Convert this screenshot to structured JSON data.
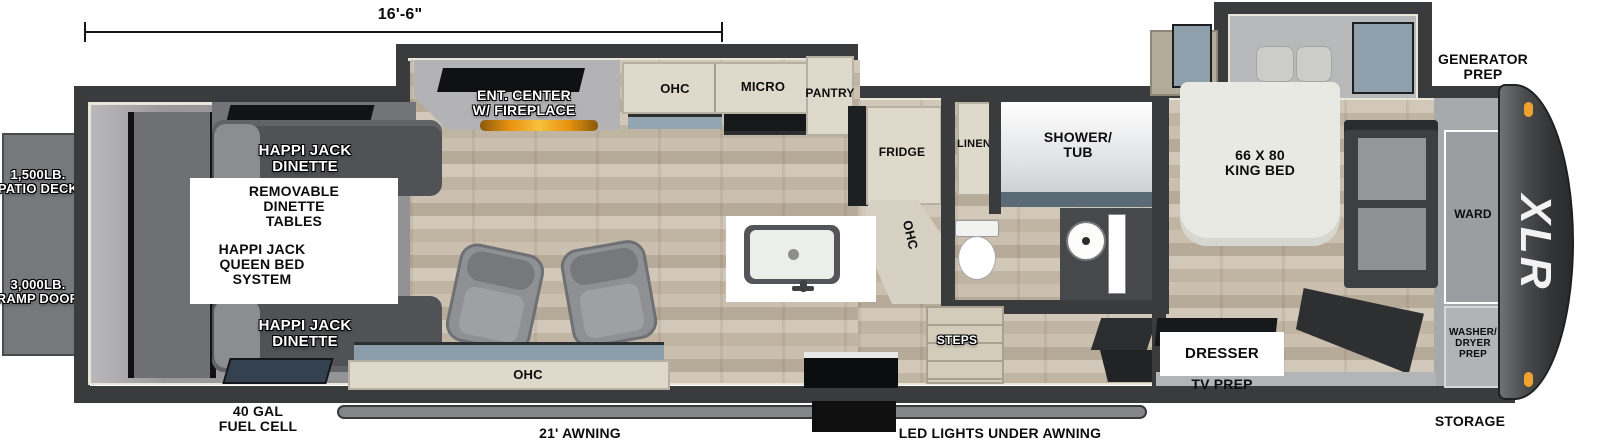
{
  "title": "XLR toy hauler floorplan",
  "dimension": {
    "garage_length": "16'-6\""
  },
  "exterior": {
    "patio_deck": "1,500LB.\nPATIO DECK",
    "ramp_door": "3,000LB.\nRAMP DOOR",
    "fuel_cell": "40 GAL\nFUEL CELL",
    "awning": "21' AWNING",
    "led_lights": "LED LIGHTS UNDER AWNING",
    "storage": "STORAGE",
    "generator_prep": "GENERATOR\nPREP",
    "brand": "XLR"
  },
  "garage": {
    "dinette_top": "HAPPI JACK\nDINETTE",
    "dinette_bottom": "HAPPI JACK\nDINETTE",
    "removable_tables": "REMOVABLE\nDINETTE\nTABLES",
    "queen_bed_system": "HAPPI JACK\nQUEEN BED\nSYSTEM"
  },
  "living": {
    "ent_center": "ENT. CENTER\nW/ FIREPLACE",
    "ohc_top": "OHC",
    "micro": "MICRO",
    "pantry": "PANTRY",
    "fridge": "FRIDGE",
    "ohc_kitchen": "OHC",
    "ohc_bottom": "OHC"
  },
  "bath": {
    "linen": "LINEN",
    "shower_tub": "SHOWER/\nTUB",
    "steps": "STEPS"
  },
  "bedroom": {
    "king_bed": "66 X 80\nKING BED",
    "dresser": "DRESSER",
    "tv_prep": "TV PREP",
    "ward": "WARD",
    "washer_dryer": "WASHER/\nDRYER\nPREP"
  },
  "colors": {
    "hull": "#3a3b3d",
    "trim_cream": "#e9e5d9",
    "wood_floor": "#c9bfb0",
    "cabinet_cream": "#ded9ca",
    "window_glass": "#8fa0ac",
    "fireplace_glow": "#e8920f",
    "marker_light": "#f0a22e",
    "deck_gray": "#77787b"
  }
}
